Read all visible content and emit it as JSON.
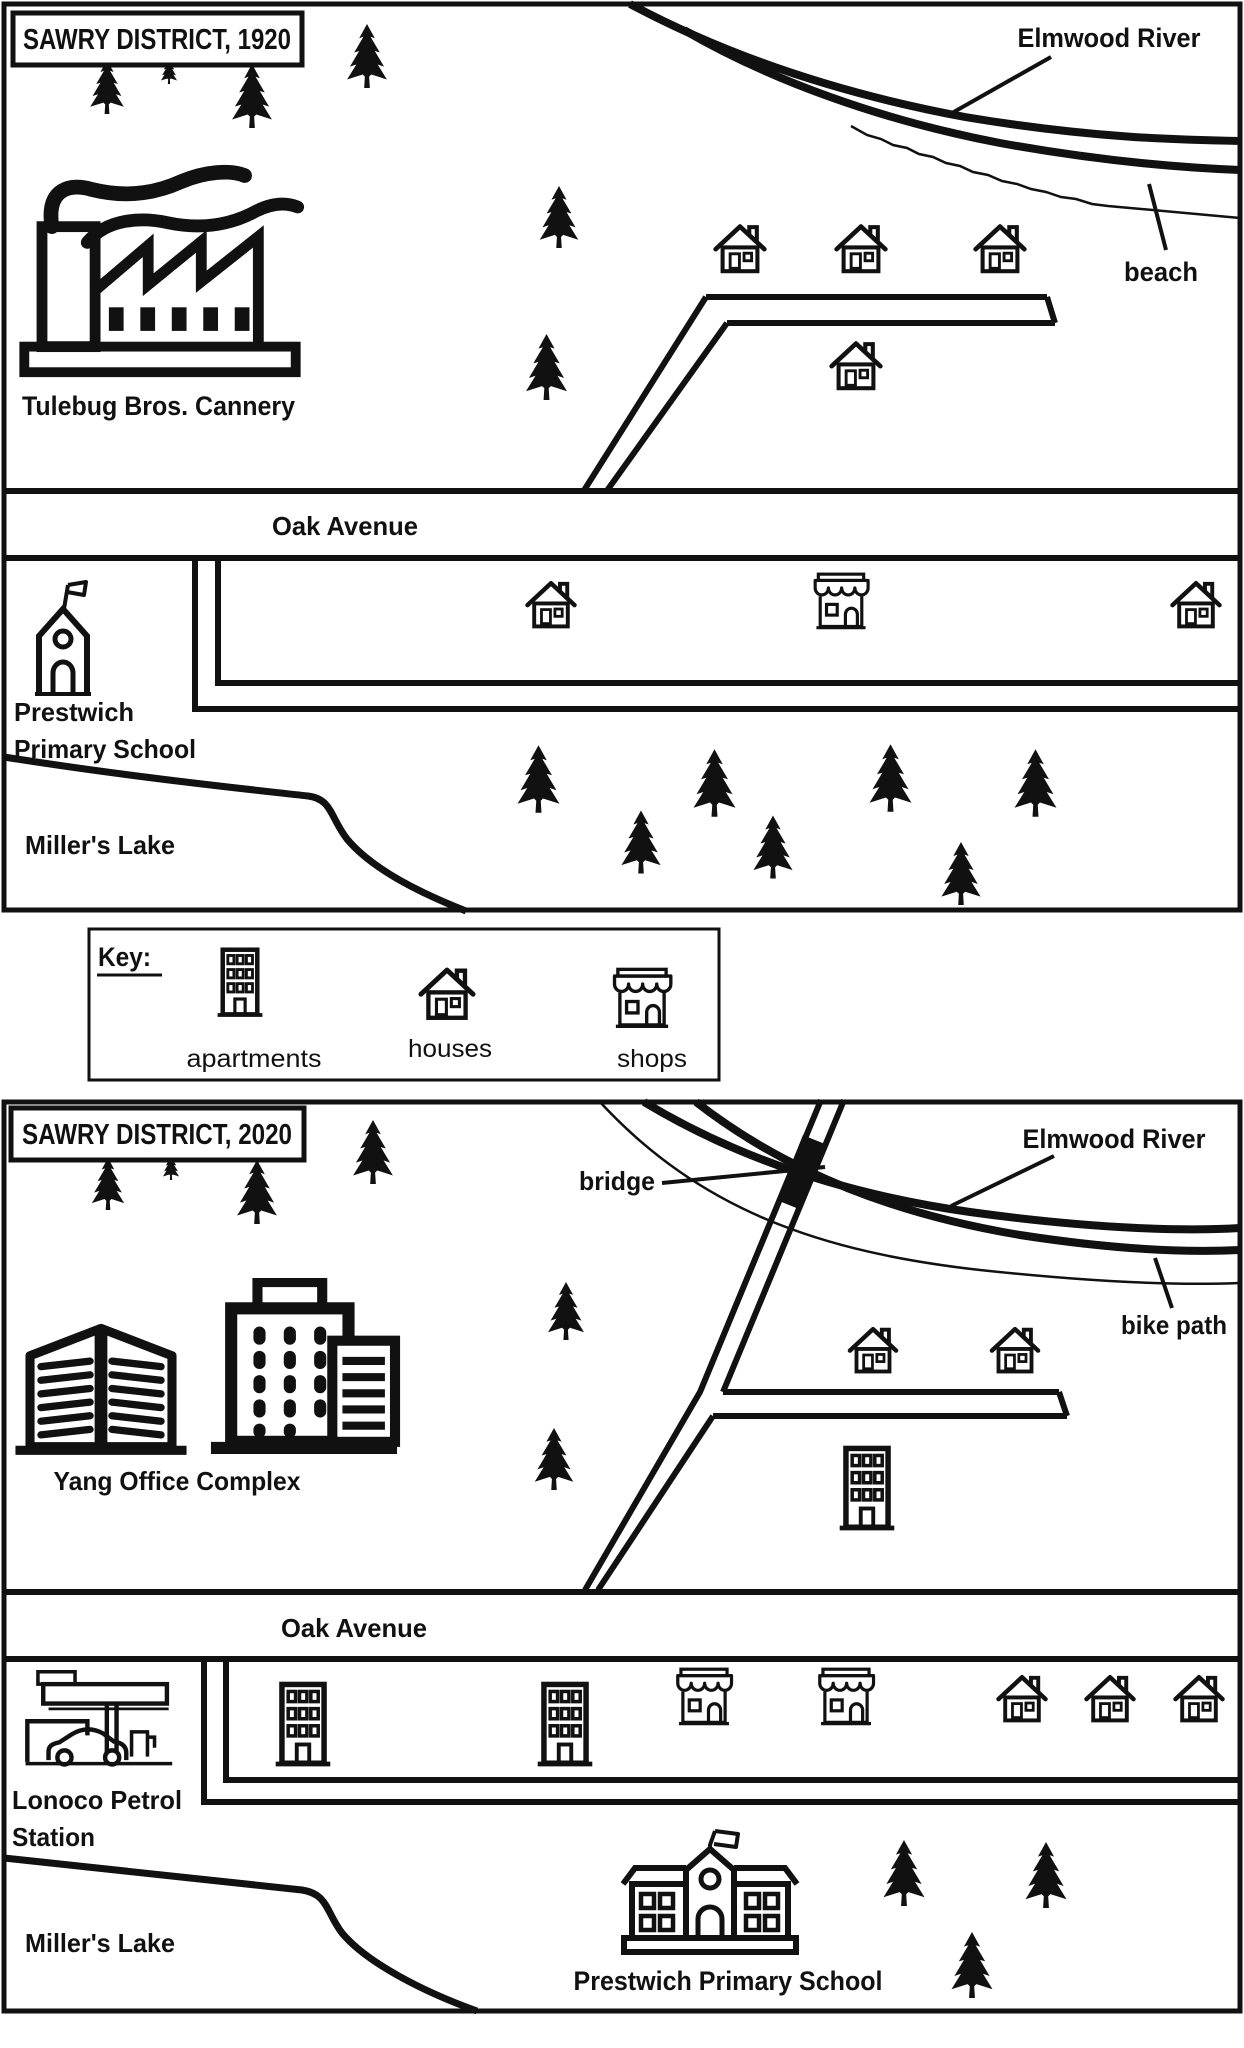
{
  "page": {
    "background": "#ffffff",
    "ink": "#111111"
  },
  "maps": [
    {
      "id": "map-1920",
      "title": "SAWRY DISTRICT, 1920",
      "labels": {
        "river": "Elmwood River",
        "beach": "beach",
        "factory": "Tulebug Bros. Cannery",
        "road": "Oak Avenue",
        "school_line1": "Prestwich",
        "school_line2": "Primary School",
        "lake": "Miller's Lake"
      },
      "icons": [
        {
          "type": "tree",
          "x": 84,
          "y": 60,
          "w": 46,
          "h": 54
        },
        {
          "type": "tree",
          "x": 150,
          "y": 58,
          "w": 38,
          "h": 26
        },
        {
          "type": "tree",
          "x": 228,
          "y": 64,
          "w": 48,
          "h": 64
        },
        {
          "type": "tree",
          "x": 344,
          "y": 24,
          "w": 46,
          "h": 64
        },
        {
          "type": "tree",
          "x": 536,
          "y": 186,
          "w": 46,
          "h": 62
        },
        {
          "type": "tree",
          "x": 524,
          "y": 334,
          "w": 45,
          "h": 66
        },
        {
          "type": "factory",
          "x": 12,
          "y": 148,
          "w": 296,
          "h": 236
        },
        {
          "type": "house",
          "x": 711,
          "y": 219,
          "w": 58,
          "h": 58
        },
        {
          "type": "house",
          "x": 832,
          "y": 219,
          "w": 58,
          "h": 58
        },
        {
          "type": "house",
          "x": 971,
          "y": 219,
          "w": 58,
          "h": 58
        },
        {
          "type": "house",
          "x": 827,
          "y": 336,
          "w": 58,
          "h": 58
        },
        {
          "type": "chapel",
          "x": 26,
          "y": 576,
          "w": 72,
          "h": 122
        },
        {
          "type": "house",
          "x": 523,
          "y": 576,
          "w": 56,
          "h": 56
        },
        {
          "type": "shop",
          "x": 809,
          "y": 571,
          "w": 64,
          "h": 63
        },
        {
          "type": "house",
          "x": 1168,
          "y": 576,
          "w": 56,
          "h": 56
        },
        {
          "type": "tree",
          "x": 516,
          "y": 740,
          "w": 45,
          "h": 78
        },
        {
          "type": "tree",
          "x": 620,
          "y": 804,
          "w": 42,
          "h": 76
        },
        {
          "type": "tree",
          "x": 692,
          "y": 744,
          "w": 45,
          "h": 78
        },
        {
          "type": "tree",
          "x": 752,
          "y": 810,
          "w": 42,
          "h": 74
        },
        {
          "type": "tree",
          "x": 868,
          "y": 738,
          "w": 45,
          "h": 80
        },
        {
          "type": "tree",
          "x": 940,
          "y": 836,
          "w": 42,
          "h": 75
        },
        {
          "type": "tree",
          "x": 1013,
          "y": 744,
          "w": 45,
          "h": 78
        }
      ]
    },
    {
      "id": "map-2020",
      "title": "SAWRY DISTRICT, 2020",
      "labels": {
        "river": "Elmwood River",
        "bridge": "bridge",
        "bike_path": "bike path",
        "offices": "Yang Office Complex",
        "road": "Oak Avenue",
        "petrol_line1": "Lonoco Petrol",
        "petrol_line2": "Station",
        "school": "Prestwich Primary School",
        "lake": "Miller's Lake"
      },
      "icons": [
        {
          "type": "tree",
          "x": 86,
          "y": 1158,
          "w": 44,
          "h": 52
        },
        {
          "type": "tree",
          "x": 152,
          "y": 1154,
          "w": 38,
          "h": 26
        },
        {
          "type": "tree",
          "x": 234,
          "y": 1160,
          "w": 46,
          "h": 64
        },
        {
          "type": "tree",
          "x": 350,
          "y": 1120,
          "w": 46,
          "h": 64
        },
        {
          "type": "tree",
          "x": 545,
          "y": 1282,
          "w": 42,
          "h": 58
        },
        {
          "type": "tree",
          "x": 532,
          "y": 1428,
          "w": 44,
          "h": 62
        },
        {
          "type": "officeL",
          "x": 10,
          "y": 1310,
          "w": 182,
          "h": 146
        },
        {
          "type": "officeR",
          "x": 200,
          "y": 1278,
          "w": 208,
          "h": 178
        },
        {
          "type": "house",
          "x": 845,
          "y": 1322,
          "w": 56,
          "h": 55
        },
        {
          "type": "house",
          "x": 987,
          "y": 1322,
          "w": 56,
          "h": 55
        },
        {
          "type": "apartment",
          "x": 828,
          "y": 1438,
          "w": 78,
          "h": 102
        },
        {
          "type": "petrol",
          "x": 10,
          "y": 1670,
          "w": 176,
          "h": 106
        },
        {
          "type": "apartment",
          "x": 264,
          "y": 1674,
          "w": 78,
          "h": 102
        },
        {
          "type": "apartment",
          "x": 526,
          "y": 1674,
          "w": 78,
          "h": 102
        },
        {
          "type": "shop",
          "x": 672,
          "y": 1666,
          "w": 64,
          "h": 64
        },
        {
          "type": "shop",
          "x": 814,
          "y": 1666,
          "w": 64,
          "h": 64
        },
        {
          "type": "house",
          "x": 994,
          "y": 1670,
          "w": 56,
          "h": 56
        },
        {
          "type": "house",
          "x": 1082,
          "y": 1670,
          "w": 56,
          "h": 56
        },
        {
          "type": "house",
          "x": 1171,
          "y": 1670,
          "w": 56,
          "h": 56
        },
        {
          "type": "school",
          "x": 606,
          "y": 1828,
          "w": 208,
          "h": 134
        },
        {
          "type": "tree",
          "x": 882,
          "y": 1840,
          "w": 44,
          "h": 66
        },
        {
          "type": "tree",
          "x": 1024,
          "y": 1842,
          "w": 44,
          "h": 66
        },
        {
          "type": "tree",
          "x": 950,
          "y": 1932,
          "w": 44,
          "h": 66
        }
      ]
    }
  ],
  "key": {
    "title": "Key:",
    "items": [
      {
        "type": "apartment",
        "label": "apartments"
      },
      {
        "type": "house",
        "label": "houses"
      },
      {
        "type": "shop",
        "label": "shops"
      }
    ]
  }
}
